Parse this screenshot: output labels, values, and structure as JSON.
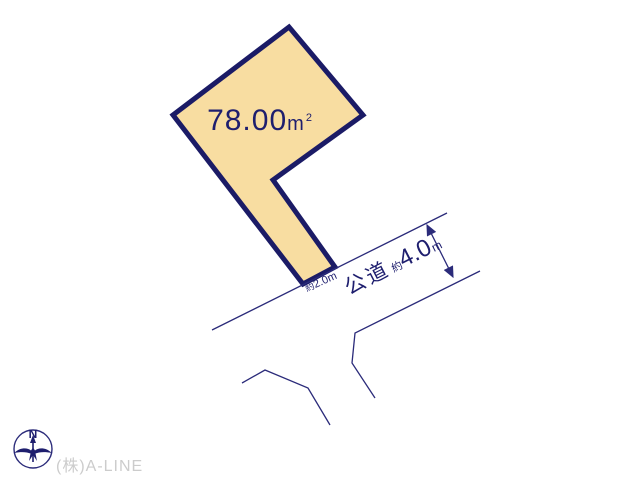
{
  "colors": {
    "outline": "#1b1b66",
    "line": "#2b2b7a",
    "text": "#1e1e6e",
    "parcel_fill": "#f8dda1",
    "company_text": "#cccccc",
    "background": "#ffffff"
  },
  "parcel": {
    "area_value": "78.00",
    "area_unit_base": "m",
    "area_unit_sup": "2"
  },
  "frontage": {
    "approx": "約",
    "value": "2.0m"
  },
  "road": {
    "name": "公道",
    "approx": "約",
    "width_value": "4.0",
    "width_unit": "m"
  },
  "compass": {
    "north_label": "N"
  },
  "footer": {
    "company": "(株)A-LINE"
  }
}
